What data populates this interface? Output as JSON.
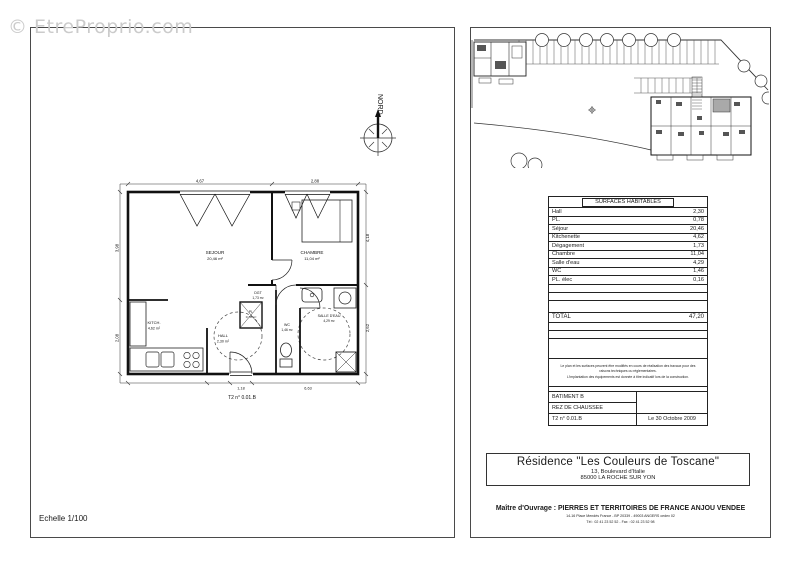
{
  "watermark": "© EtreProprio.com",
  "left_panel": {
    "scale_label": "Echelle 1/100",
    "north_label": "NORD",
    "unit_label": "T2 n° 0.01.B",
    "rooms": [
      {
        "name": "SEJOUR",
        "area": "20,46 m²"
      },
      {
        "name": "CHAMBRE",
        "area": "11,04 m²"
      },
      {
        "name": "KITCH.",
        "area": "4,62 m²"
      },
      {
        "name": "HALL",
        "area": "2,30 m²"
      },
      {
        "name": "DGT",
        "area": "1,73 m²"
      },
      {
        "name": "PL",
        "area": "0,78 m²"
      },
      {
        "name": "WC",
        "area": "1,46 m²"
      },
      {
        "name": "SALLE D'EAU",
        "area": "4,29 m²"
      }
    ],
    "dims": {
      "top_left": "4,67",
      "top_right": "2,88",
      "left_top": "3,98",
      "left_bottom": "2,08",
      "right_top": "4,18",
      "right_bottom": "2,62",
      "bottom_left": "1,18",
      "bottom_right": "6,63"
    }
  },
  "surfaces_table": {
    "title": "SURFACES HABITABLES",
    "rows": [
      {
        "label": "Hall",
        "value": "2,30"
      },
      {
        "label": "PL.",
        "value": "0,78"
      },
      {
        "label": "Séjour",
        "value": "20,46"
      },
      {
        "label": "Kitchenette",
        "value": "4,62"
      },
      {
        "label": "Dégagement",
        "value": "1,73"
      },
      {
        "label": "Chambre",
        "value": "11,04"
      },
      {
        "label": "Salle d'eau",
        "value": "4,29"
      },
      {
        "label": "WC",
        "value": "1,46"
      },
      {
        "label": "PL. élec",
        "value": "0,16"
      }
    ],
    "total_label": "TOTAL",
    "total_value": "47,20",
    "note_line1": "Le plan et les surfaces peuvent être modifiés en cours de réalisation des travaux pour des raisons techniques ou réglementaires.",
    "note_line2": "L'implantation des équipements est donnée à titre indicatif lors de la construction.",
    "building": "BATIMENT B",
    "floor": "REZ DE CHAUSSEE",
    "unit": "T2 n° 0.01.B",
    "date": "Le 30 Octobre 2009"
  },
  "title_block": {
    "residence": "Résidence \"Les Couleurs de Toscane\"",
    "address": "13, Boulevard d'Italie",
    "city": "85000 LA ROCHE SUR YON"
  },
  "footer": {
    "owner": "Maître d'Ouvrage : PIERRES ET TERRITOIRES DE FRANCE ANJOU VENDEE",
    "address": "14-16 Place Mendès France - BP 20339 - 49003 ANGERS cedex 02",
    "phone": "Tél : 02 41 23 52 52 - Fax : 02 41 23 52 98"
  }
}
